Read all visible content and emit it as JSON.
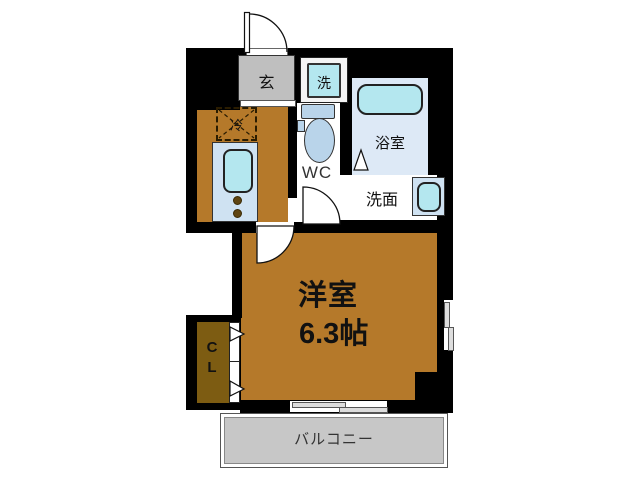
{
  "figure_type": "japanese-apartment-floor-plan",
  "labels": {
    "entrance": "玄",
    "washer": "洗",
    "bathroom": "浴室",
    "toilet": "WC",
    "washroom": "洗面",
    "refrigerator": "冷",
    "main_room_name": "洋室",
    "main_room_size": "6.3帖",
    "closet": "CL",
    "balcony": "バルコニー"
  },
  "colors": {
    "wall": "#000000",
    "flooring": "#b5792a",
    "closet_floor": "#7d5c12",
    "entrance_floor": "#bfbfbf",
    "fixture_panel": "#cfe2f2",
    "fixture_water": "#b4e7ef",
    "bathroom_floor": "#dde9f6",
    "balcony_floor": "#c7c7c7"
  }
}
